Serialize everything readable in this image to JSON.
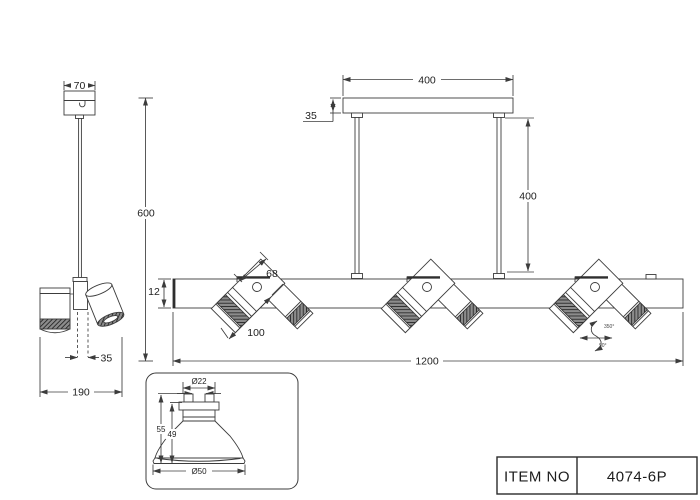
{
  "drawing": {
    "side_view": {
      "canopy_width": "70",
      "suspension_height": "600",
      "center_offset": "35",
      "fixture_width": "190"
    },
    "front_view": {
      "canopy_length": "400",
      "canopy_height": "35",
      "rod_length": "400",
      "spot_width": "68",
      "bar_thickness": "12",
      "spot_length": "100",
      "bar_length": "1200",
      "rotation_horizontal": "350°",
      "rotation_vertical": "90°"
    },
    "bulb_detail": {
      "top_diameter": "Ø22",
      "overall_height": "55",
      "body_height": "49",
      "face_diameter": "Ø50"
    }
  },
  "title_block": {
    "label": "ITEM NO",
    "item_no": "4074-6P"
  },
  "colors": {
    "line": "#3c3c3c",
    "text": "#222222",
    "background": "#ffffff"
  }
}
